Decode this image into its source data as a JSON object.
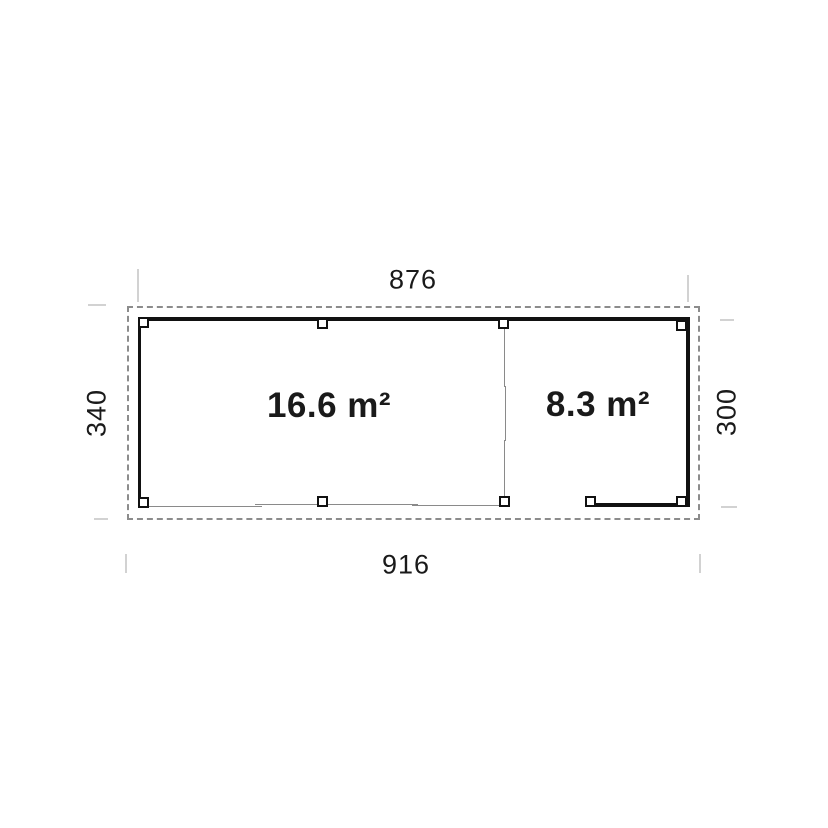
{
  "plan": {
    "type": "floor-plan",
    "rooms": [
      {
        "label": "16.6 m²"
      },
      {
        "label": "8.3 m²"
      }
    ],
    "dimensions": {
      "top": "876",
      "bottom": "916",
      "left": "340",
      "right": "300"
    },
    "colors": {
      "background": "#ffffff",
      "wall": "#111111",
      "boundary_dash": "#8c8c8c",
      "thin_line": "#8a8a8a",
      "tick": "#d2d2d2",
      "text": "#1a1a1a"
    }
  }
}
